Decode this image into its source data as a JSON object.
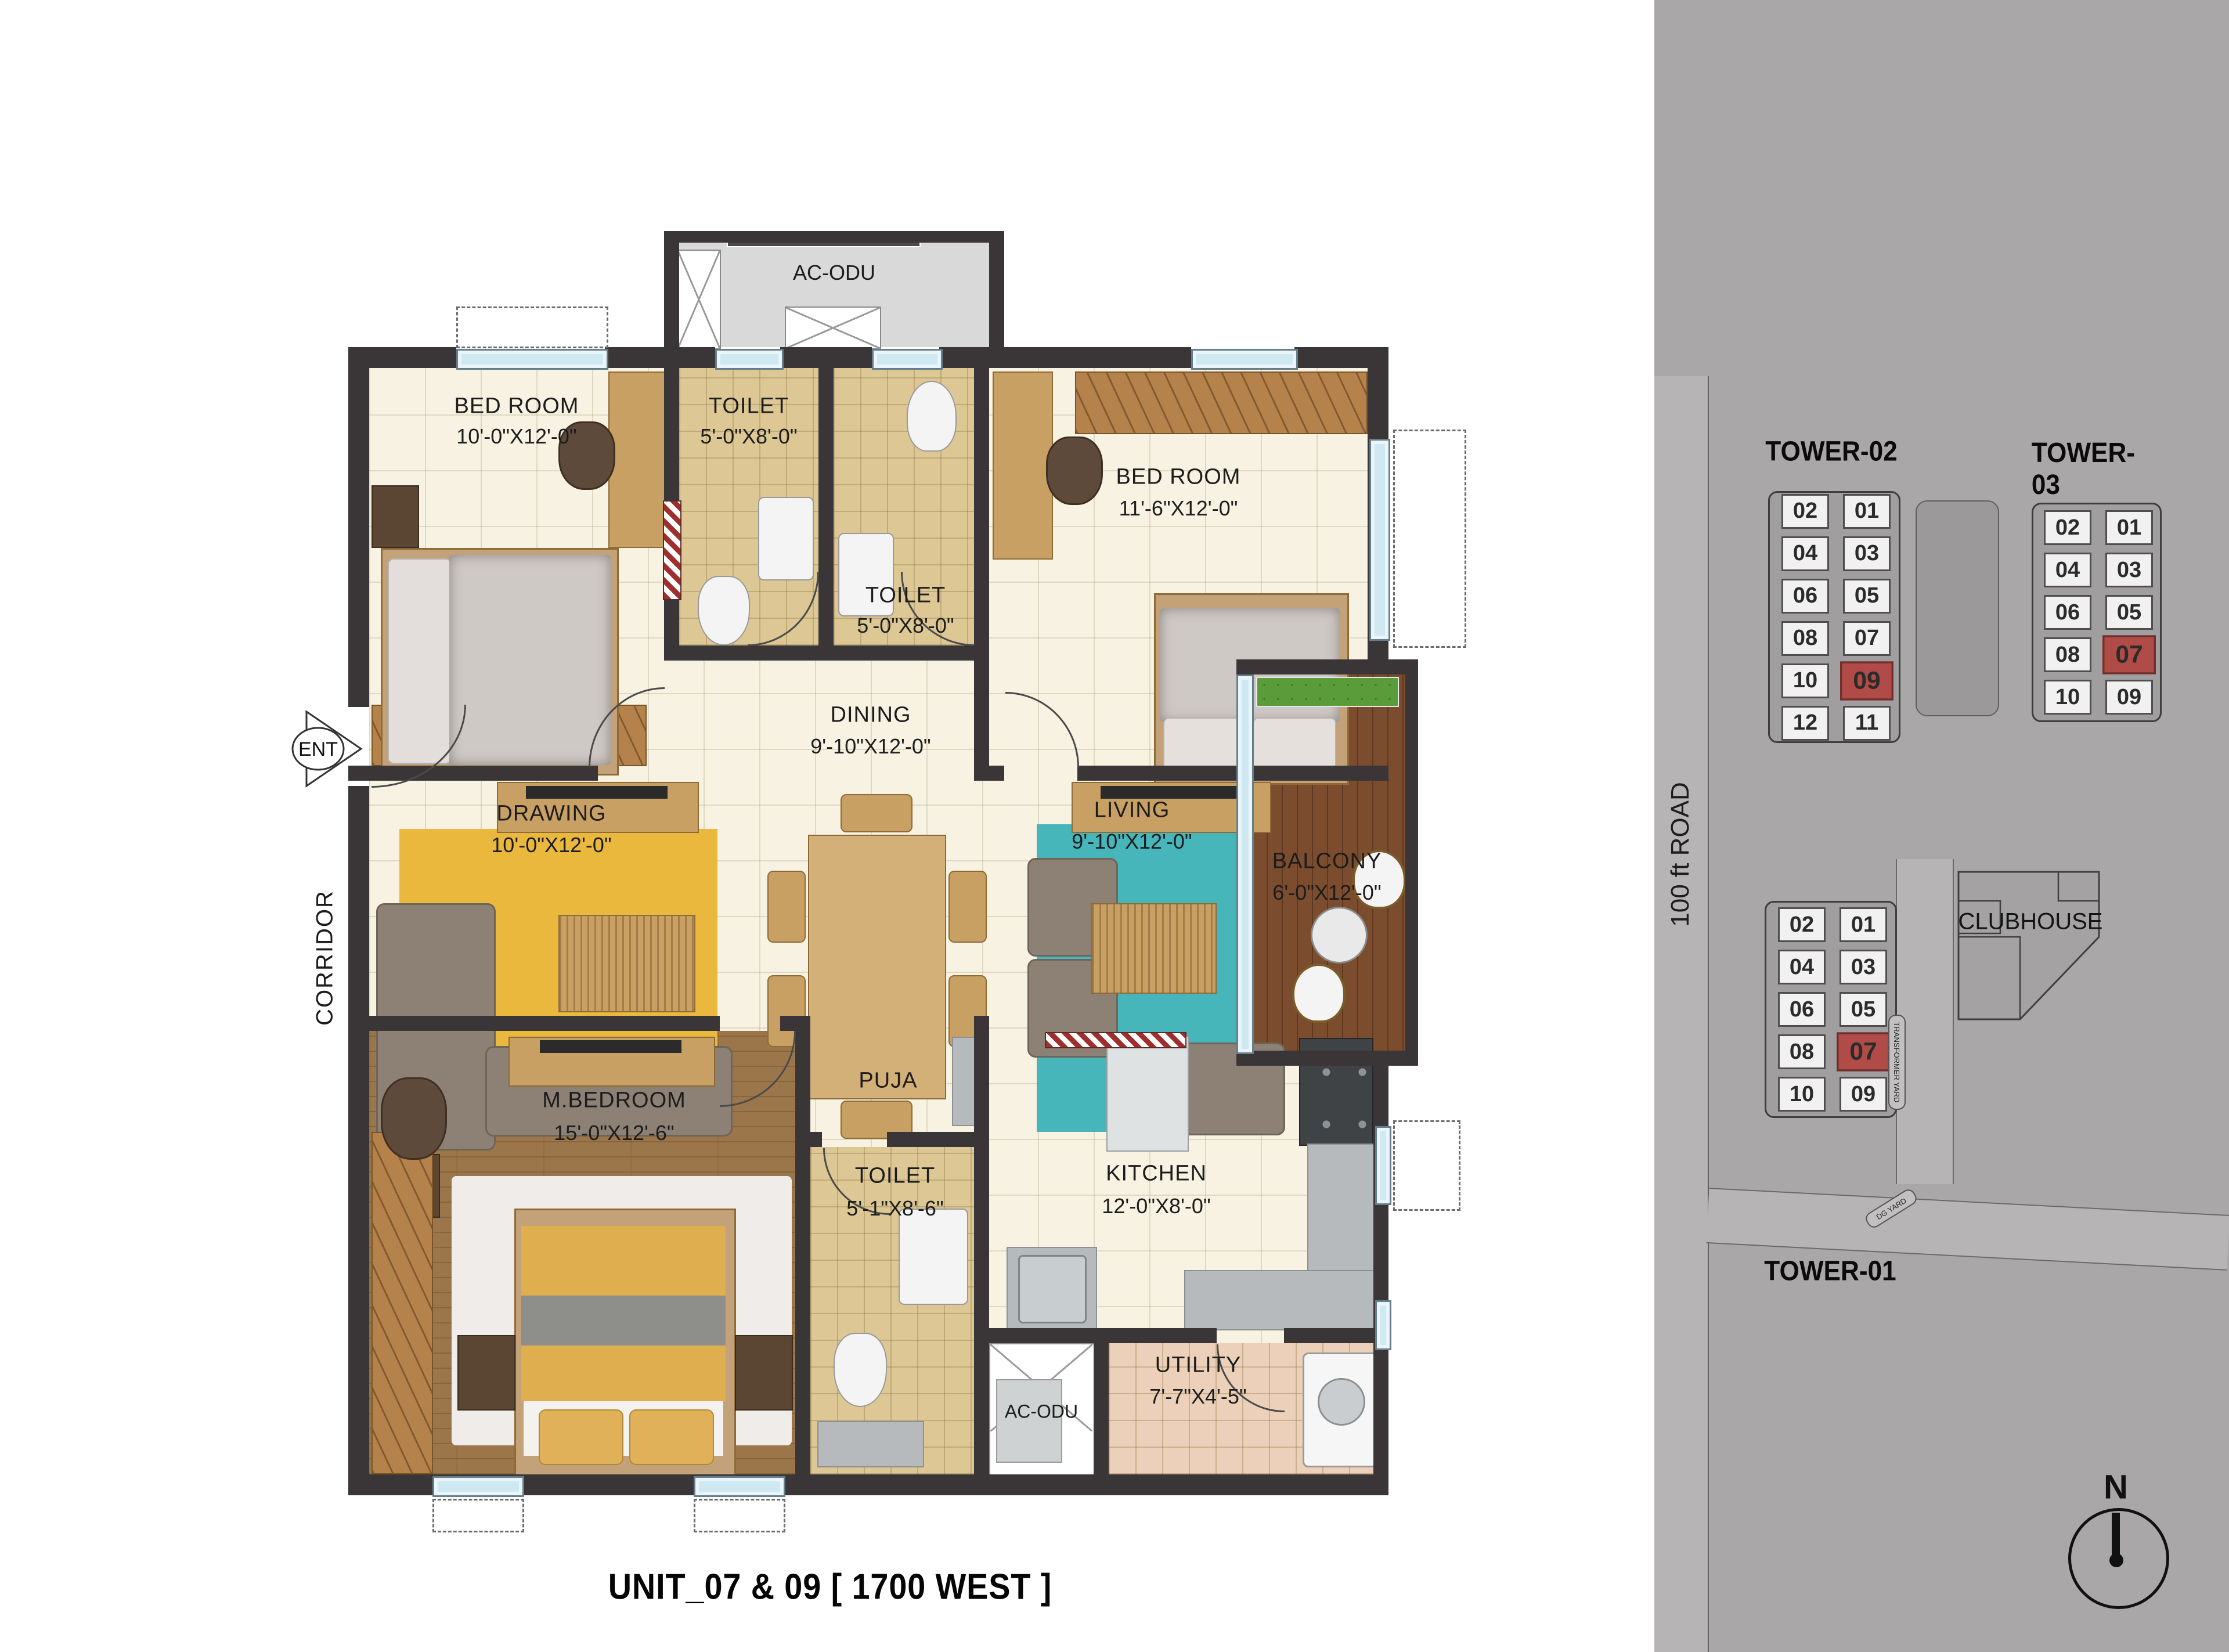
{
  "title": "UNIT_07 & 09 [ 1700 WEST ]",
  "floor_plan": {
    "entry_label": "ENT",
    "corridor_label": "CORRIDOR",
    "rooms": [
      {
        "id": "bedroom1",
        "name": "BED ROOM",
        "dims": "10'-0\"X12'-0\""
      },
      {
        "id": "toilet1",
        "name": "TOILET",
        "dims": "5'-0\"X8'-0\""
      },
      {
        "id": "toilet2",
        "name": "TOILET",
        "dims": "5'-0\"X8'-0\""
      },
      {
        "id": "bedroom2",
        "name": "BED ROOM",
        "dims": "11'-6\"X12'-0\""
      },
      {
        "id": "drawing",
        "name": "DRAWING",
        "dims": "10'-0\"X12'-0\""
      },
      {
        "id": "dining",
        "name": "DINING",
        "dims": "9'-10\"X12'-0\""
      },
      {
        "id": "living",
        "name": "LIVING",
        "dims": "9'-10\"X12'-0\""
      },
      {
        "id": "balcony",
        "name": "BALCONY",
        "dims": "6'-0\"X12'-0\""
      },
      {
        "id": "mbedroom",
        "name": "M.BEDROOM",
        "dims": "15'-0\"X12'-6\""
      },
      {
        "id": "puja",
        "name": "PUJA",
        "dims": ""
      },
      {
        "id": "toilet3",
        "name": "TOILET",
        "dims": "5'-1\"X8'-6\""
      },
      {
        "id": "kitchen",
        "name": "KITCHEN",
        "dims": "12'-0\"X8'-0\""
      },
      {
        "id": "utility",
        "name": "UTILITY",
        "dims": "7'-7\"X4'-5\""
      },
      {
        "id": "acodu_top",
        "name": "AC-ODU",
        "dims": ""
      },
      {
        "id": "acodu_bottom",
        "name": "AC-ODU",
        "dims": ""
      }
    ]
  },
  "site_plan": {
    "road_label": "100 ft ROAD",
    "clubhouse_label": "CLUBHOUSE",
    "transformer_yard_label": "TRANSFORMER YARD",
    "dg_yard_label": "DG YARD",
    "north_label": "N",
    "towers": [
      {
        "name": "TOWER-02",
        "rows": [
          [
            "02",
            "01"
          ],
          [
            "04",
            "03"
          ],
          [
            "06",
            "05"
          ],
          [
            "08",
            "07"
          ],
          [
            "10",
            "09"
          ],
          [
            "12",
            "11"
          ]
        ],
        "highlighted": [
          "09"
        ]
      },
      {
        "name": "TOWER-03",
        "rows": [
          [
            "02",
            "01"
          ],
          [
            "04",
            "03"
          ],
          [
            "06",
            "05"
          ],
          [
            "08",
            "07"
          ],
          [
            "10",
            "09"
          ]
        ],
        "highlighted": [
          "07"
        ]
      },
      {
        "name": "TOWER-01",
        "rows": [
          [
            "02",
            "01"
          ],
          [
            "04",
            "03"
          ],
          [
            "06",
            "05"
          ],
          [
            "08",
            "07"
          ],
          [
            "10",
            "09"
          ]
        ],
        "highlighted": [
          "07"
        ]
      }
    ]
  },
  "colors": {
    "wall": "#3a3637",
    "cream_floor": "#f7f2e1",
    "tan_floor": "#dcc795",
    "wood_floor": "#9b764a",
    "deck": "#7c4c2e",
    "teal_rug": "#46b6bb",
    "yellow_rug": "#e9b83d",
    "utility_floor": "#ecd0b9",
    "window": "#cfe9f3",
    "highlight_unit": "#b14b47",
    "panel_gray": "#a9a7a8",
    "road_gray": "#b6b4b5",
    "planter_green": "#5a9c3a"
  }
}
